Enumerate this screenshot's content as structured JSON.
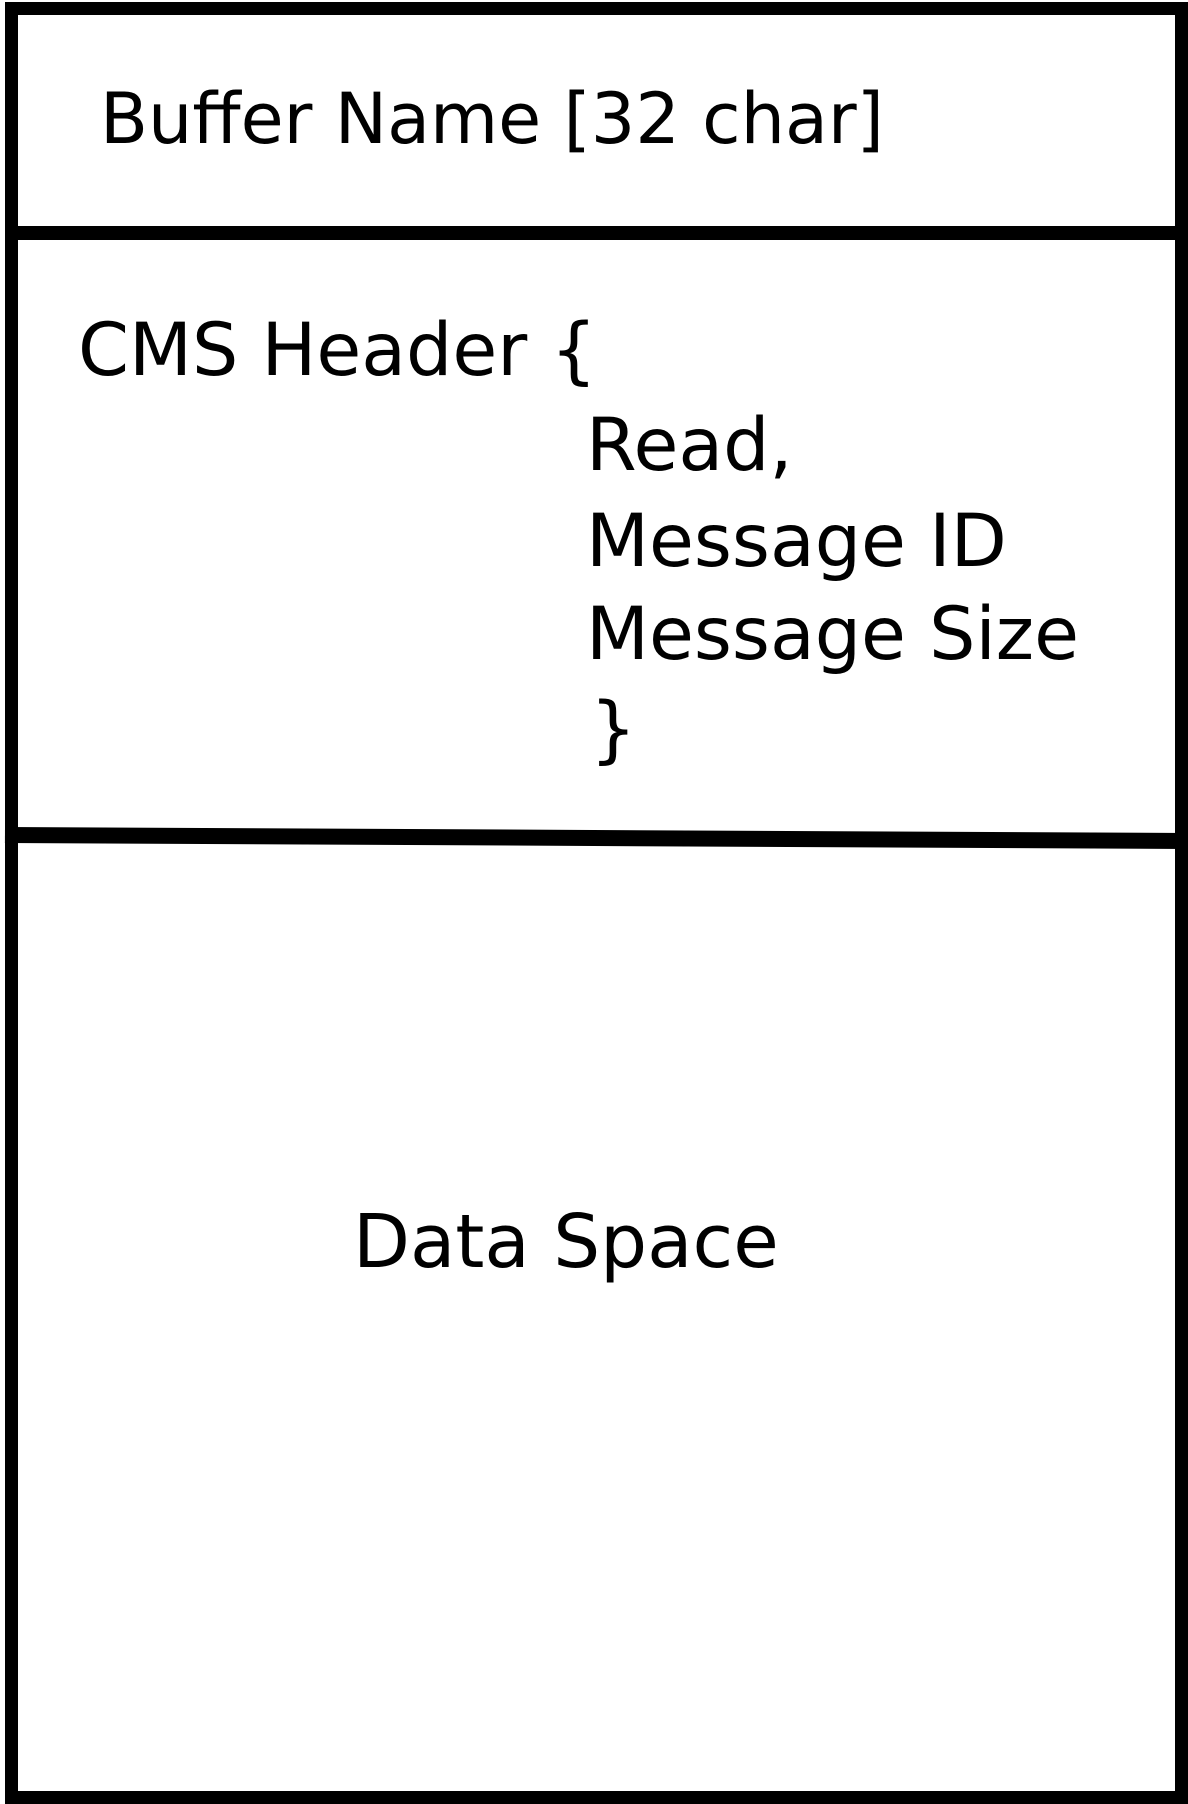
{
  "figure": {
    "buffer_name_label": "Buffer Name [32 char]",
    "cms_header": {
      "open": "CMS Header {",
      "fields": [
        "Read,",
        "Message ID",
        "Message Size"
      ],
      "close": "}"
    },
    "data_space_label": "Data Space"
  },
  "colors": {
    "ink": "#000000",
    "background": "#ffffff"
  }
}
